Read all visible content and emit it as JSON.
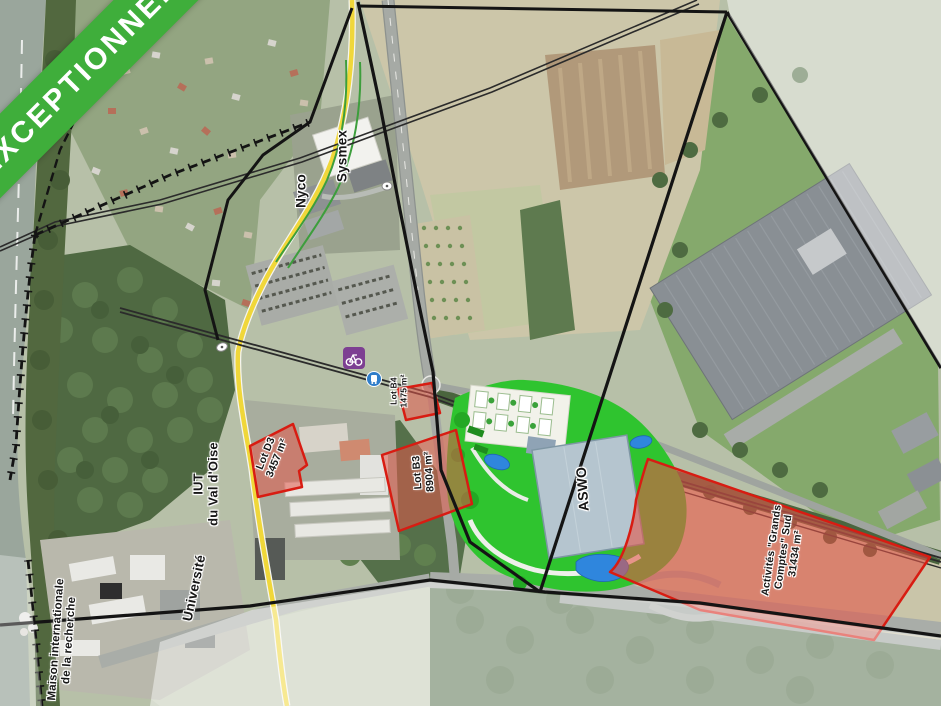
{
  "banner": {
    "text": "EXCEPTIONNEL",
    "color": "#3fae3b"
  },
  "map": {
    "colors": {
      "parcel_red_fill": "#e2574a",
      "parcel_red_border": "#d81c12",
      "parcel_green": "#2fc42f",
      "pond_blue": "#2f86dd",
      "road_yellow": "#f0d73a",
      "water": "#9aa69c"
    },
    "places": {
      "sysmex": "Sysmex",
      "nyco": "Nyco",
      "iut_line1": "IUT",
      "iut_line2": "du Val d'Oise",
      "universite": "Université",
      "maison_line1": "Maison internationale",
      "maison_line2": "de la recherche",
      "aswo": "ASWO"
    },
    "parcels": {
      "lot_b4": {
        "name": "Lot B4",
        "area": "1475 m²"
      },
      "lot_d3": {
        "name": "Lot D3",
        "area": "3457 m²"
      },
      "lot_b3": {
        "name": "Lot B3",
        "area": "8904 m²"
      },
      "grands_comptes": {
        "line1": "Activités \"Grands",
        "line2": "Comptes\" Sud",
        "area": "31434 m²"
      }
    },
    "icons": {
      "bike_station": "bike-station-icon",
      "bus_stop": "bus-stop-icon"
    }
  }
}
